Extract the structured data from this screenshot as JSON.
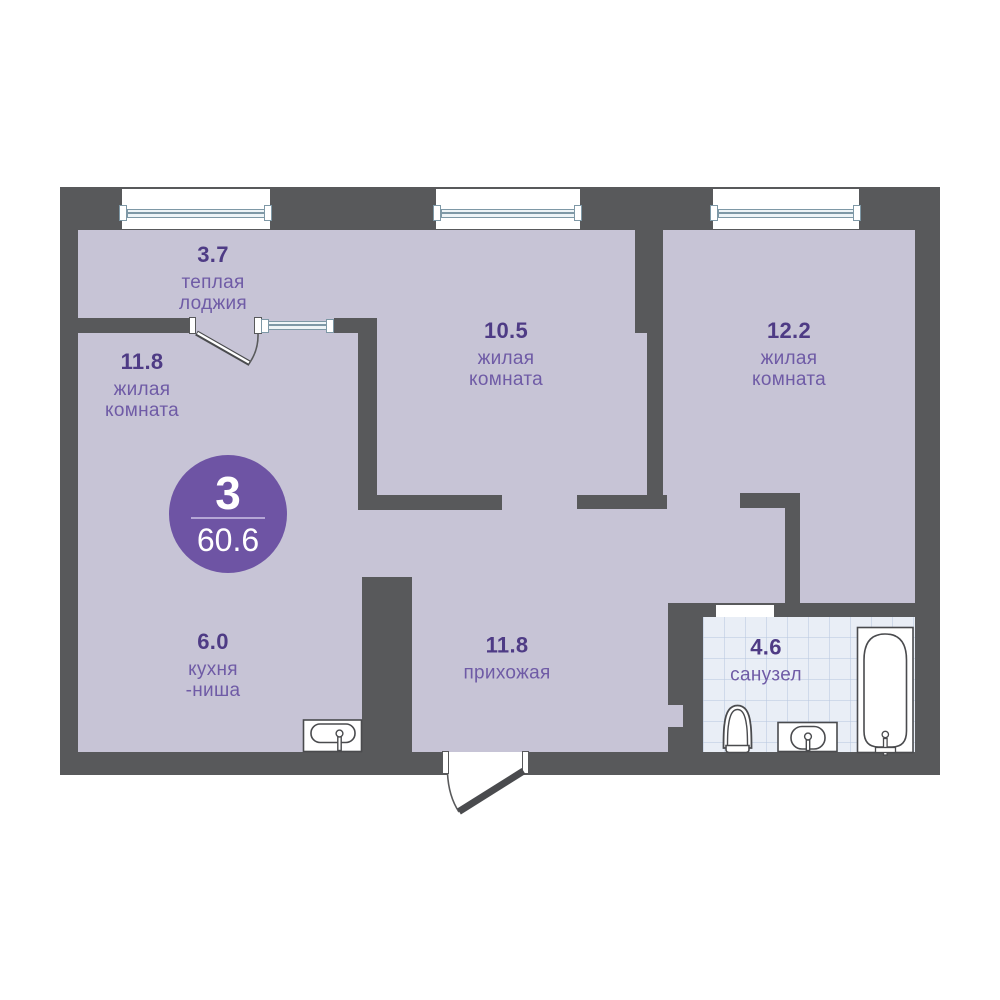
{
  "plan": {
    "type": "apartment-floor-plan",
    "badge": {
      "rooms_count": "3",
      "total_area": "60.6"
    },
    "rooms": {
      "loggia": {
        "area": "3.7",
        "line1": "теплая",
        "line2": "лоджия"
      },
      "living1": {
        "area": "11.8",
        "line1": "жилая",
        "line2": "комната"
      },
      "living2": {
        "area": "10.5",
        "line1": "жилая",
        "line2": "комната"
      },
      "living3": {
        "area": "12.2",
        "line1": "жилая",
        "line2": "комната"
      },
      "kitchen": {
        "area": "6.0",
        "line1": "кухня",
        "line2": "-ниша"
      },
      "hallway": {
        "area": "11.8",
        "line1": "прихожая"
      },
      "bathroom": {
        "area": "4.6",
        "line1": "санузел"
      }
    },
    "fixtures": [
      "kitchen-sink-icon",
      "toilet-icon",
      "washbasin-icon",
      "bathtub-icon"
    ],
    "openings": [
      "window",
      "window",
      "window",
      "loggia-window",
      "balcony-door",
      "entrance-door",
      "bathroom-door"
    ],
    "colors": {
      "wall": "#58595b",
      "floor": "#c7c4d6",
      "tile": "#e9eef6",
      "area_number": "#4e3b85",
      "room_label": "#6f5ba6",
      "badge": "#6e54a4",
      "window_frame": "#7e98a6",
      "fixture_stroke": "#4a4b4e"
    }
  }
}
